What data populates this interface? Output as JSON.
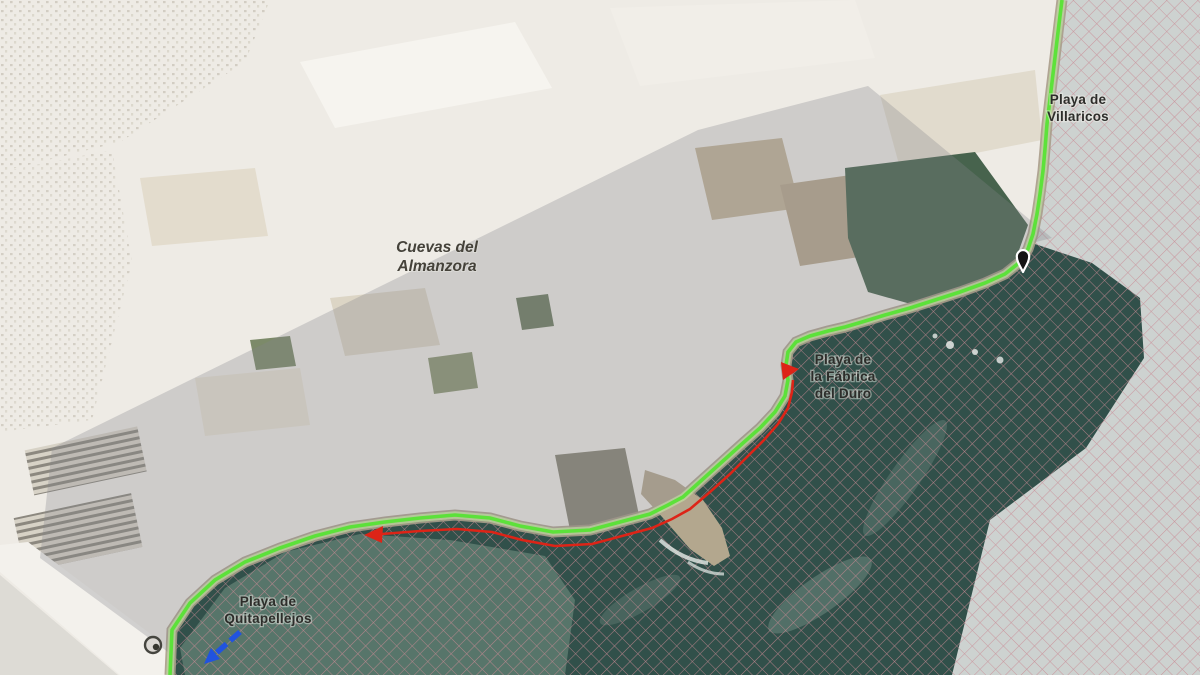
{
  "map": {
    "place_labels": {
      "municipality": {
        "line1": "Cuevas del",
        "line2": "Almanzora"
      },
      "villaricos": {
        "line1": "Playa de",
        "line2": "Villaricos"
      },
      "fabrica": {
        "line1": "Playa de",
        "line2": "la Fábrica",
        "line3": "del Duro"
      },
      "quitapellejos": {
        "line1": "Playa de",
        "line2": "Quitapellejos"
      }
    },
    "colors": {
      "land_base": "#eeebe5",
      "sea_dark": "#31504a",
      "sea_light": "#cdd2d0",
      "sea_mid": "#5e7b70",
      "hatch_pink": "#c98a94",
      "overlay_gray": "#84868b",
      "coastal_path_green": "#57e335",
      "route_arrow_red": "#dd2417",
      "segment_blue": "#2153df",
      "pin_black": "#141414",
      "pin_white": "#ffffff"
    }
  }
}
